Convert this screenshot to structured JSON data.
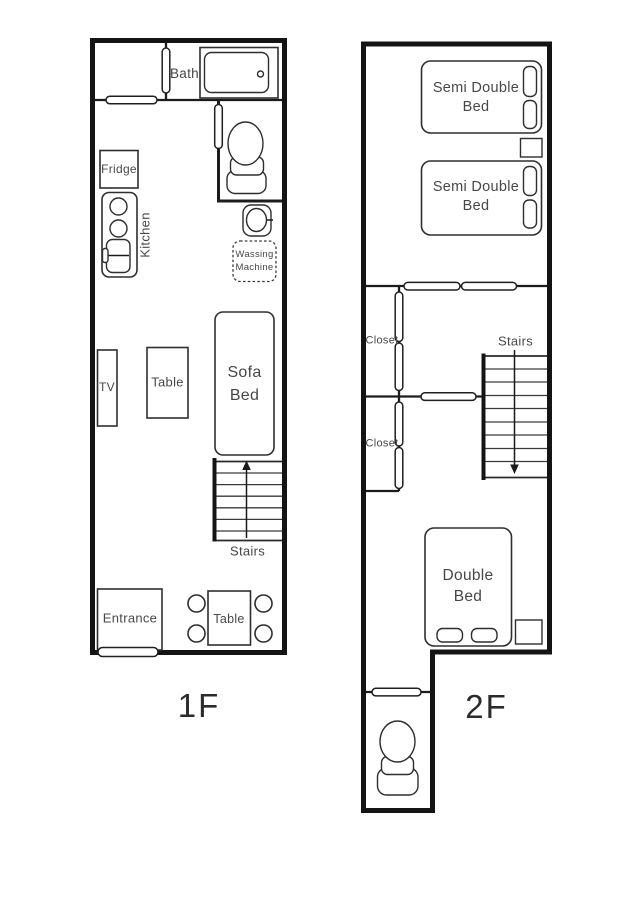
{
  "colors": {
    "background": "#ffffff",
    "wall": "#141414",
    "furniture_line": "#2e2e2e",
    "label_text": "#474747"
  },
  "floor1": {
    "floor_label": "1F",
    "bath": "Bath",
    "fridge": "Fridge",
    "kitchen": "Kitchen",
    "washing_machine": "Wassing Machine",
    "tv": "TV",
    "living_table": "Table",
    "sofa_bed": "Sofa Bed",
    "stairs": "Stairs",
    "entrance": "Entrance",
    "dining_table": "Table"
  },
  "floor2": {
    "floor_label": "2F",
    "semi_double_bed_1": "Semi Double Bed",
    "semi_double_bed_2": "Semi Double Bed",
    "closet_1": "Closet",
    "closet_2": "Closet",
    "stairs": "Stairs",
    "double_bed": "Double Bed"
  }
}
